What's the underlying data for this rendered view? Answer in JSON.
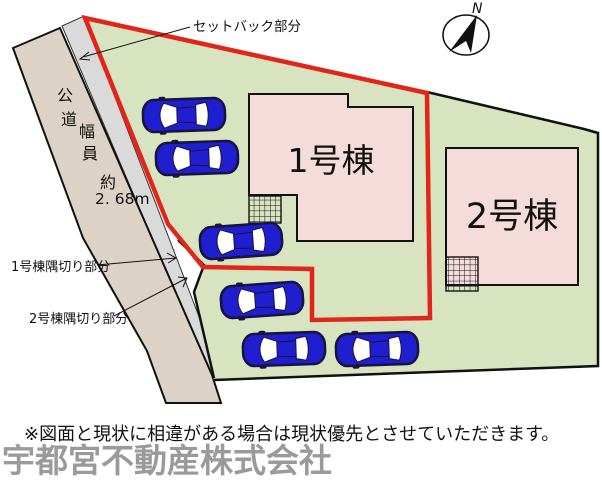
{
  "plan": {
    "building1_label": "1号棟",
    "building2_label": "2号棟",
    "setback_label": "セットバック部分",
    "corner_cut_1_label": "1号棟隅切り部分",
    "corner_cut_2_label": "2号棟隅切り部分",
    "north_label": "N",
    "road": {
      "chars": [
        "公",
        "道",
        "幅",
        "員",
        "約"
      ],
      "width_value": "2. 68m"
    }
  },
  "footer": {
    "disclaimer": "※図面と現状に相違がある場合は現状優先とさせていただきます。",
    "company_name": "宇都宮不動産株式会社"
  },
  "colors": {
    "site_green": "#d8e4c0",
    "road_tan": "#dcd2c6",
    "setback_gray": "#dadada",
    "building_pink": "#f5dcda",
    "boundary_red": "#e1251b",
    "outline_black": "#111111",
    "car_blue": "#1f1fd0",
    "car_dark": "#18123c",
    "company_gray": "#9a9a9a"
  }
}
